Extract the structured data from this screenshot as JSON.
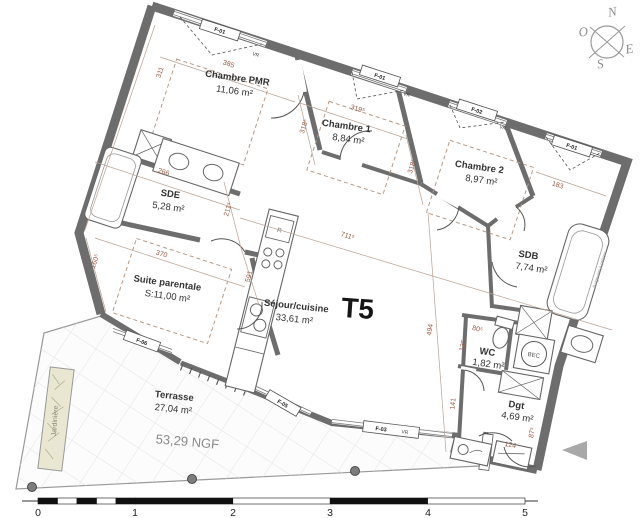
{
  "plan": {
    "type_label": "T5",
    "ngf": "53,29 NGF",
    "rooms": [
      {
        "name": "Chambre PMR",
        "area": "11,06 m²"
      },
      {
        "name": "Chambre 1",
        "area": "8,84 m²"
      },
      {
        "name": "Chambre 2",
        "area": "8,97 m²"
      },
      {
        "name": "SDE",
        "area": "5,28 m²"
      },
      {
        "name": "Suite parentale",
        "area": "S:11,00 m²"
      },
      {
        "name": "Séjour/cuisine",
        "area": "33,61 m²"
      },
      {
        "name": "SDB",
        "area": "7,74 m²"
      },
      {
        "name": "WC",
        "area": "1,82 m²"
      },
      {
        "name": "Dgt",
        "area": "4,69 m²"
      },
      {
        "name": "Terrasse",
        "area": "27,04 m²"
      }
    ],
    "fixtures": {
      "bec": "BEC",
      "fridge": "R",
      "jardiniere": "Jardinière",
      "tub_note": "Baignoire à prévoir"
    },
    "windows": [
      {
        "label": "F-01",
        "vr": "VR"
      },
      {
        "label": "F-01",
        "vr": "VR"
      },
      {
        "label": "F-02",
        "vr": "VR"
      },
      {
        "label": "F-01"
      },
      {
        "label": "F-03",
        "vr": "VR"
      },
      {
        "label": "F-04"
      },
      {
        "label": "F-05"
      },
      {
        "label": "F-06"
      }
    ],
    "dims": [
      "385",
      "311",
      "319⁵",
      "318⁵",
      "318⁵",
      "266",
      "211⁵",
      "370",
      "160⁵",
      "591",
      "711⁵",
      "494",
      "183",
      "80⁵",
      "135",
      "141",
      "87⁵",
      "124"
    ],
    "compass": {
      "n": "N",
      "o": "O",
      "e": "E",
      "s": "S"
    },
    "scalebar": [
      "0",
      "1",
      "2",
      "3",
      "4",
      "5"
    ]
  }
}
